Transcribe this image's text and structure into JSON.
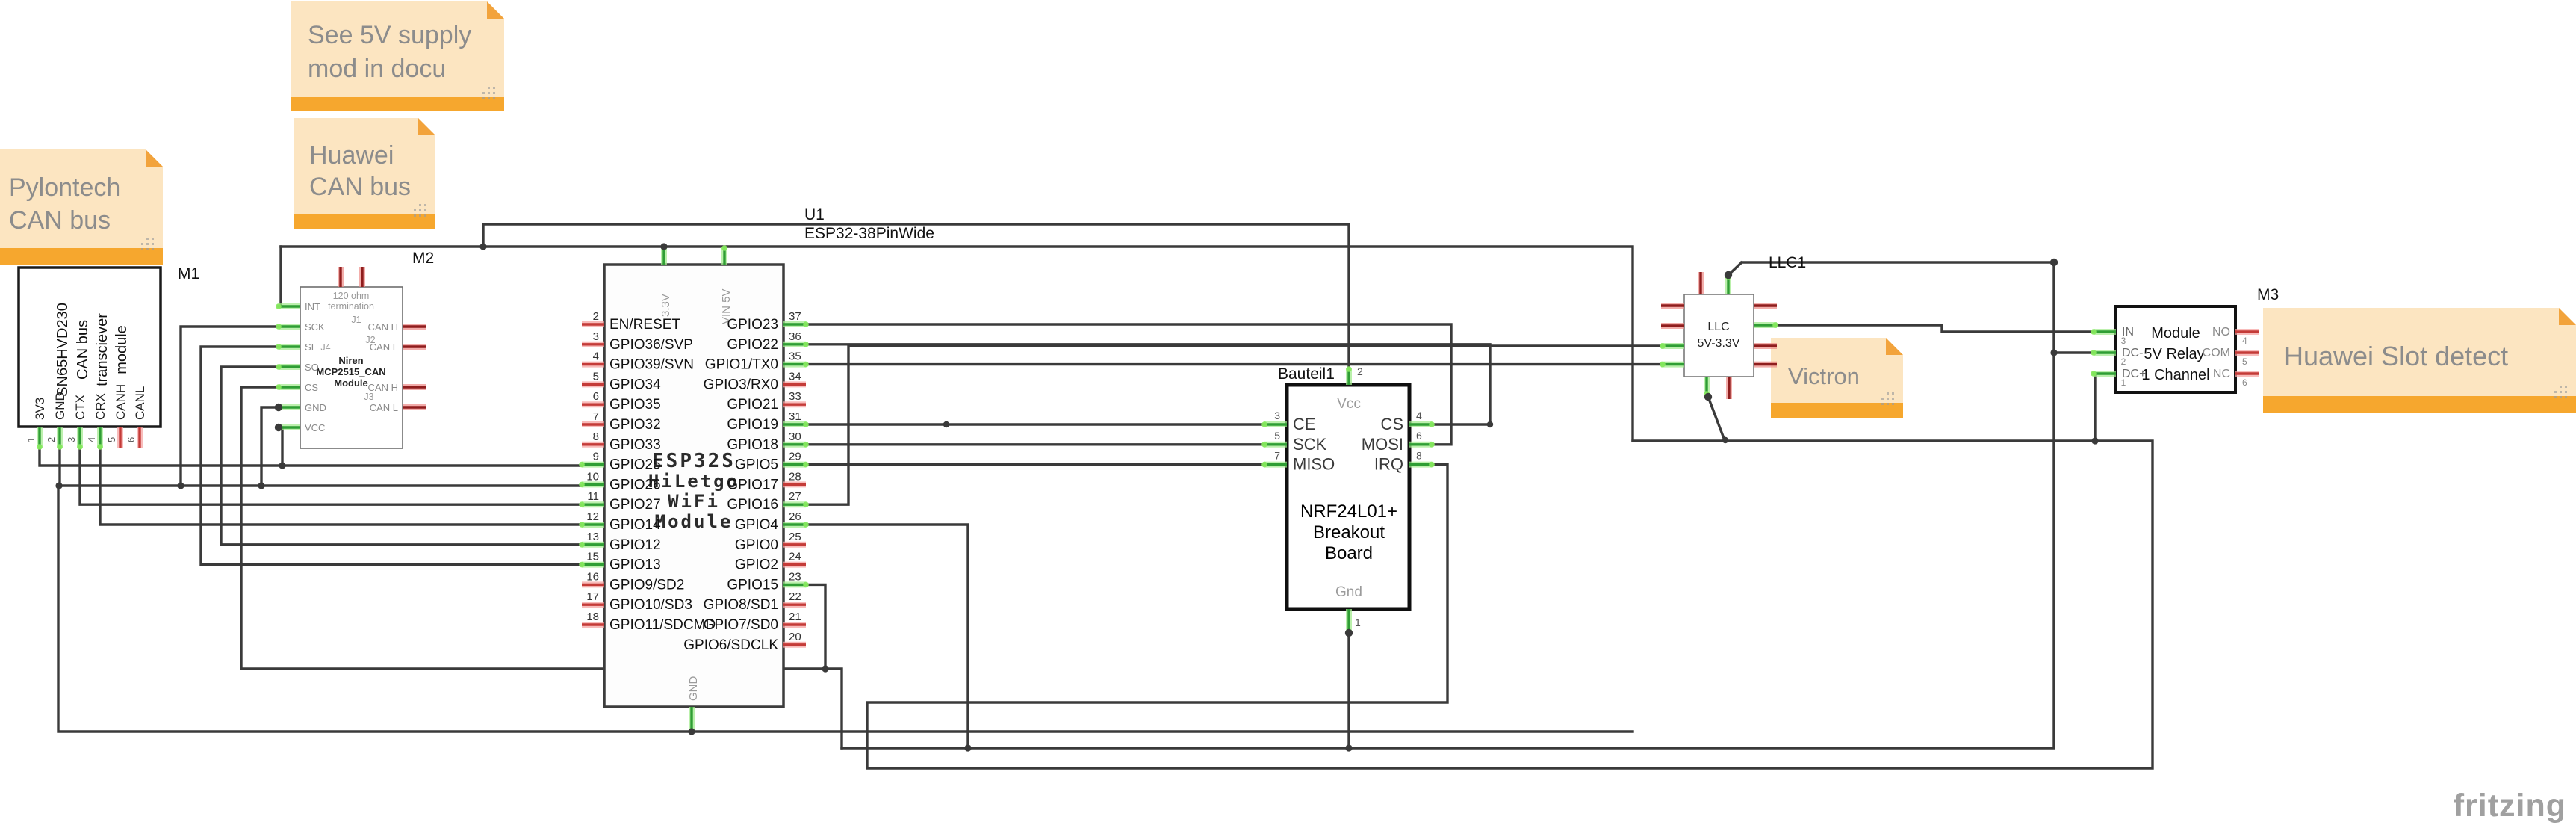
{
  "app": {
    "watermark": "fritzing"
  },
  "notes": {
    "supply": {
      "lines": [
        "See 5V supply",
        "mod in docu"
      ]
    },
    "huawei_can": {
      "lines": [
        "Huawei",
        "CAN bus"
      ]
    },
    "pylontech": {
      "lines": [
        "Pylontech",
        "CAN bus"
      ]
    },
    "victron": {
      "lines": [
        "Victron"
      ]
    },
    "huawei_slot": {
      "lines": [
        "Huawei Slot detect"
      ]
    }
  },
  "m1": {
    "ref": "M1",
    "body": [
      "SN65HVD230",
      "CAN bus",
      "transciever",
      "module"
    ],
    "pins": [
      {
        "n": "1",
        "label": "3V3",
        "c": true
      },
      {
        "n": "2",
        "label": "GND",
        "c": true
      },
      {
        "n": "3",
        "label": "CTX",
        "c": true
      },
      {
        "n": "4",
        "label": "CRX",
        "c": true
      },
      {
        "n": "5",
        "label": "CANH",
        "c": false
      },
      {
        "n": "6",
        "label": "CANL",
        "c": false
      }
    ]
  },
  "m2": {
    "ref": "M2",
    "left": [
      {
        "label": "INT",
        "c": true
      },
      {
        "label": "SCK",
        "c": true
      },
      {
        "label": "SI",
        "c": true
      },
      {
        "label": "SO",
        "c": true
      },
      {
        "label": "CS",
        "c": true
      },
      {
        "label": "GND",
        "c": true
      },
      {
        "label": "VCC",
        "c": true
      }
    ],
    "right": [
      {
        "label": "CAN H",
        "c": false
      },
      {
        "label": "CAN L",
        "c": false
      },
      {
        "label": "CAN H",
        "c": false
      },
      {
        "label": "CAN L",
        "c": false
      }
    ],
    "inner": {
      "r1": "120 ohm",
      "r2": "termination",
      "j1": "J1",
      "j2": "J2",
      "j4": "J4",
      "brand": "Niren",
      "chip": "MCP2515_CAN",
      "module": "Module",
      "j3": "J3"
    }
  },
  "esp32": {
    "ref": "U1",
    "part": "ESP32-38PinWide",
    "top": [
      "3.3V",
      "VIN 5V"
    ],
    "bottom": "GND",
    "center": [
      "ESP32S",
      "HiLetgo",
      "WiFi",
      "Module"
    ],
    "left": [
      {
        "n": "2",
        "label": "EN/RESET",
        "c": false
      },
      {
        "n": "3",
        "label": "GPIO36/SVP",
        "c": false
      },
      {
        "n": "4",
        "label": "GPIO39/SVN",
        "c": false
      },
      {
        "n": "5",
        "label": "GPIO34",
        "c": false
      },
      {
        "n": "6",
        "label": "GPIO35",
        "c": false
      },
      {
        "n": "7",
        "label": "GPIO32",
        "c": false
      },
      {
        "n": "8",
        "label": "GPIO33",
        "c": false
      },
      {
        "n": "9",
        "label": "GPIO25",
        "c": true
      },
      {
        "n": "10",
        "label": "GPIO26",
        "c": true
      },
      {
        "n": "11",
        "label": "GPIO27",
        "c": true
      },
      {
        "n": "12",
        "label": "GPIO14",
        "c": true
      },
      {
        "n": "13",
        "label": "GPIO12",
        "c": true
      },
      {
        "n": "15",
        "label": "GPIO13",
        "c": true
      },
      {
        "n": "16",
        "label": "GPIO9/SD2",
        "c": false
      },
      {
        "n": "17",
        "label": "GPIO10/SD3",
        "c": false
      },
      {
        "n": "18",
        "label": "GPIO11/SDCMD",
        "c": false
      }
    ],
    "right": [
      {
        "n": "37",
        "label": "GPIO23",
        "c": true
      },
      {
        "n": "36",
        "label": "GPIO22",
        "c": true
      },
      {
        "n": "35",
        "label": "GPIO1/TX0",
        "c": true
      },
      {
        "n": "34",
        "label": "GPIO3/RX0",
        "c": false
      },
      {
        "n": "33",
        "label": "GPIO21",
        "c": false
      },
      {
        "n": "31",
        "label": "GPIO19",
        "c": true
      },
      {
        "n": "30",
        "label": "GPIO18",
        "c": true
      },
      {
        "n": "29",
        "label": "GPIO5",
        "c": true
      },
      {
        "n": "28",
        "label": "GPIO17",
        "c": false
      },
      {
        "n": "27",
        "label": "GPIO16",
        "c": true
      },
      {
        "n": "26",
        "label": "GPIO4",
        "c": true
      },
      {
        "n": "25",
        "label": "GPIO0",
        "c": false
      },
      {
        "n": "24",
        "label": "GPIO2",
        "c": false
      },
      {
        "n": "23",
        "label": "GPIO15",
        "c": true
      },
      {
        "n": "22",
        "label": "GPIO8/SD1",
        "c": false
      },
      {
        "n": "21",
        "label": "GPIO7/SD0",
        "c": false
      },
      {
        "n": "20",
        "label": "GPIO6/SDCLK",
        "c": false
      }
    ]
  },
  "nrf": {
    "ref": "Bauteil1",
    "top": {
      "n": "2",
      "label": "Vcc"
    },
    "bot": {
      "n": "1",
      "label": "Gnd"
    },
    "left": [
      {
        "n": "3",
        "label": "CE",
        "c": true
      },
      {
        "n": "5",
        "label": "SCK",
        "c": true
      },
      {
        "n": "7",
        "label": "MISO",
        "c": true
      }
    ],
    "right": [
      {
        "n": "4",
        "label": "CS",
        "c": true
      },
      {
        "n": "6",
        "label": "MOSI",
        "c": true
      },
      {
        "n": "8",
        "label": "IRQ",
        "c": true
      }
    ],
    "center": [
      "NRF24L01+",
      "Breakout",
      "Board"
    ]
  },
  "llc": {
    "ref": "LLC1",
    "center": [
      "LLC",
      "5V-3.3V"
    ]
  },
  "relay": {
    "ref": "M3",
    "left": [
      {
        "n": "3",
        "label": "IN",
        "c": true
      },
      {
        "n": "2",
        "label": "DC-",
        "c": true
      },
      {
        "n": "1",
        "label": "DC+",
        "c": true
      }
    ],
    "right": [
      {
        "n": "4",
        "label": "NO",
        "c": false
      },
      {
        "n": "5",
        "label": "COM",
        "c": false
      },
      {
        "n": "6",
        "label": "NC",
        "c": false
      }
    ],
    "center": [
      "Module",
      "5V Relay",
      "1 Channel"
    ]
  },
  "colors": {
    "wire": "#3A3A3A",
    "connected_core": "#2F9E34",
    "connected_halo": "#A4EB8F",
    "connected_tip": "#86E95F",
    "unconnected_core": "#C43B38",
    "unconnected_halo": "#F6A3A1",
    "dark_red_core": "#8F1D1D",
    "dark_red_halo": "#EE8C88",
    "note_body": "#FCE5C1",
    "note_bar": "#F6A72E",
    "note_text": "#8C8C8C"
  }
}
